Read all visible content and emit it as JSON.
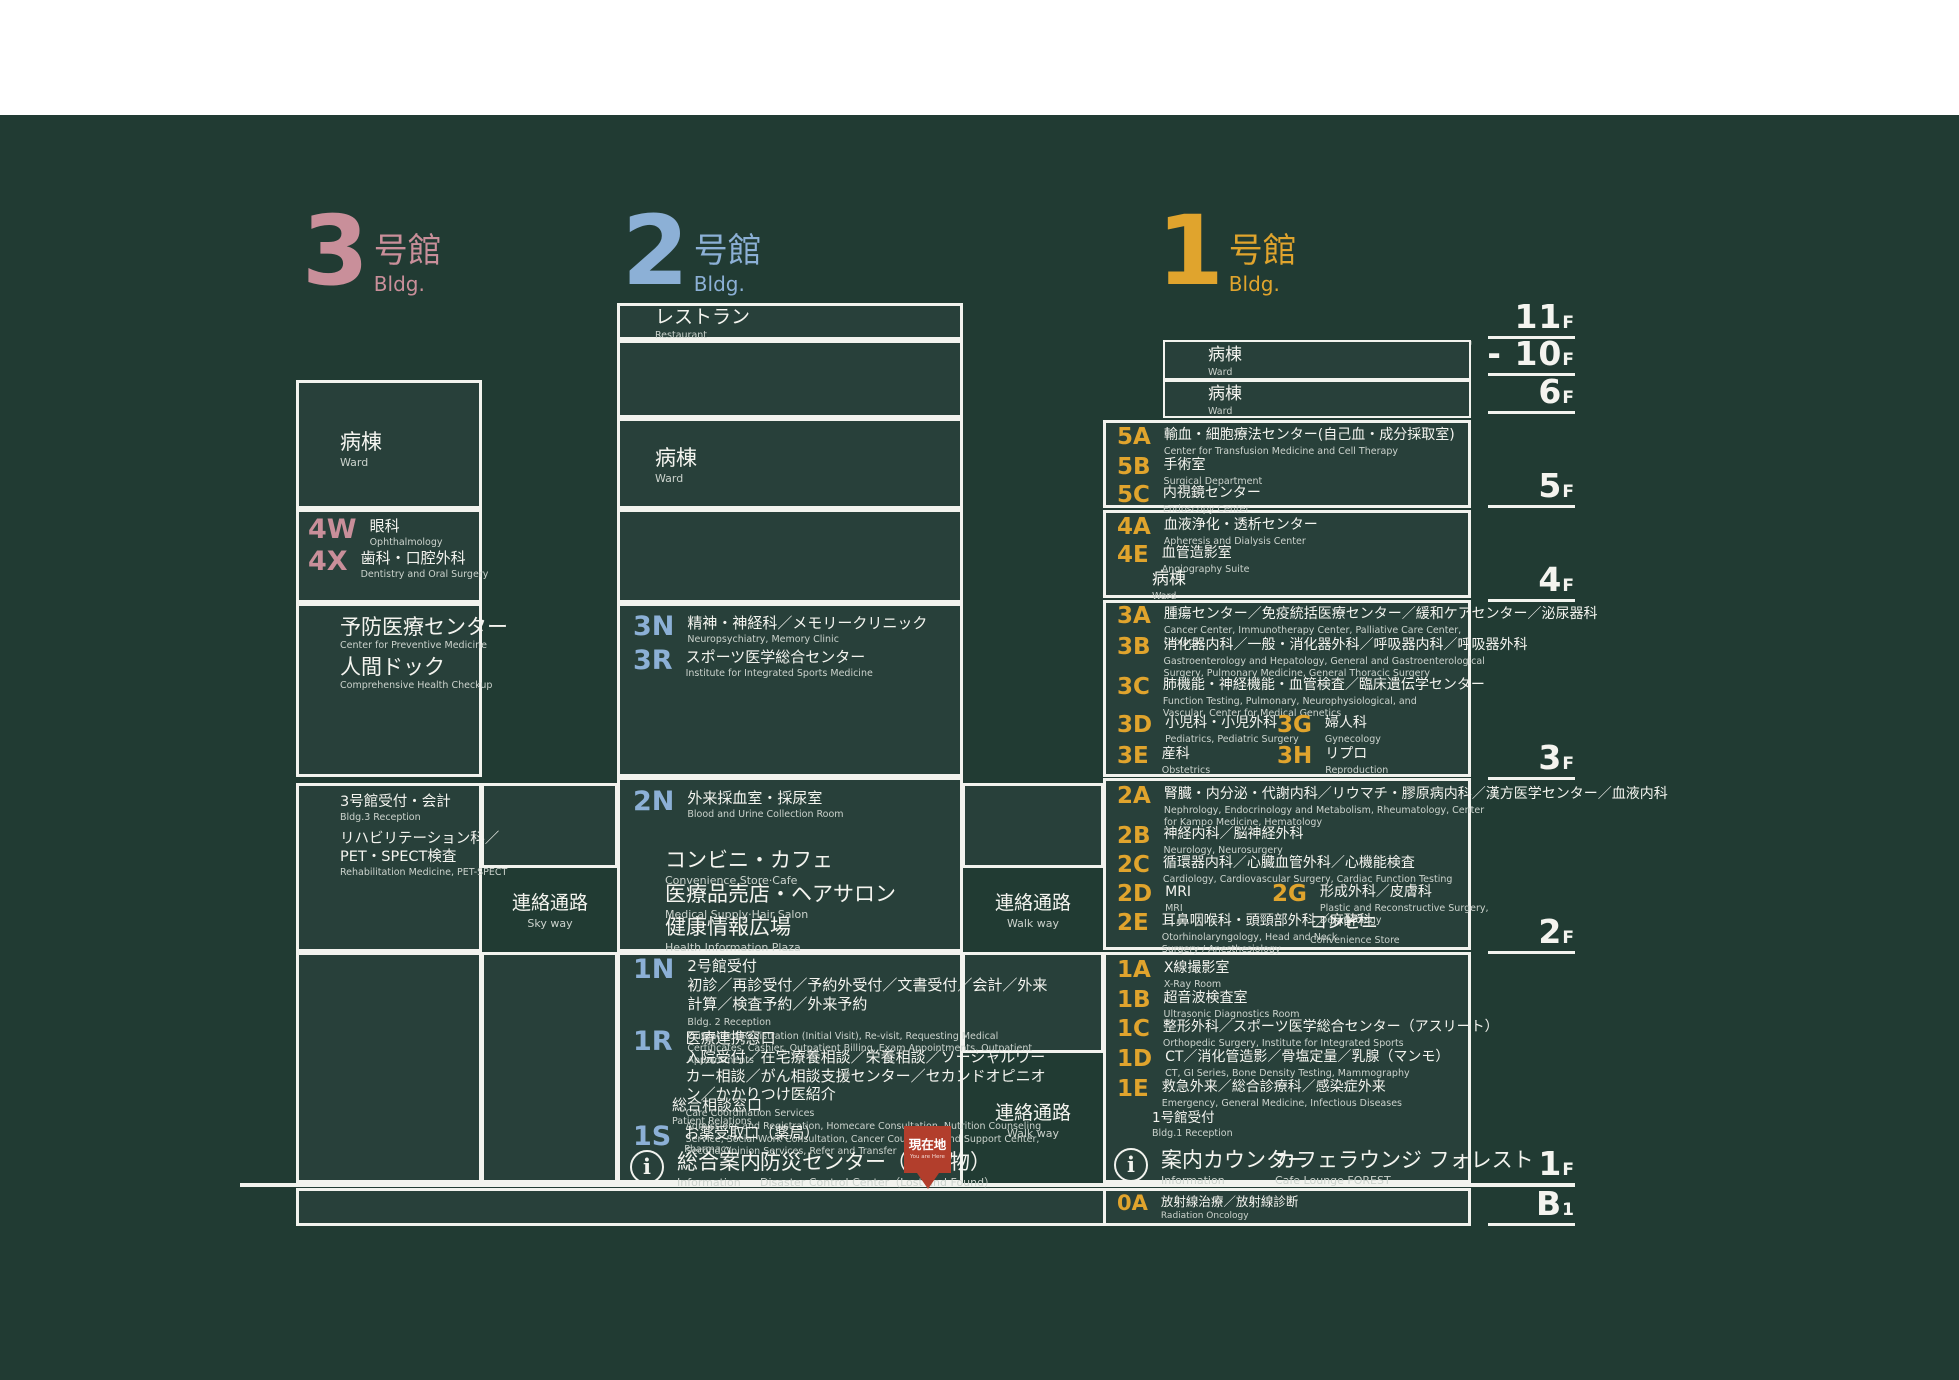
{
  "page": {
    "background": "#ffffff",
    "panel_bg": "#213b33",
    "box_border": "#f2f3ee",
    "accent_pink": "#c98f9a",
    "accent_blue": "#8cb0d6",
    "accent_gold": "#e0a42d",
    "marker_red": "#b23e2c"
  },
  "headers": {
    "b3": {
      "num": "3",
      "kan": "号館",
      "bldg": "Bldg."
    },
    "b2": {
      "num": "2",
      "kan": "号館",
      "bldg": "Bldg."
    },
    "b1": {
      "num": "1",
      "kan": "号館",
      "bldg": "Bldg."
    }
  },
  "floors": [
    {
      "n": "11",
      "s": "F"
    },
    {
      "n": "7 - 10",
      "s": "F"
    },
    {
      "n": "6",
      "s": "F"
    },
    {
      "n": "5",
      "s": "F"
    },
    {
      "n": "4",
      "s": "F"
    },
    {
      "n": "3",
      "s": "F"
    },
    {
      "n": "2",
      "s": "F"
    },
    {
      "n": "1",
      "s": "F"
    },
    {
      "n": "B",
      "s": "1"
    }
  ],
  "b3": {
    "ward": {
      "jp": "病棟",
      "en": "Ward"
    },
    "rooms": [
      {
        "code": "4W",
        "jp": "眼科",
        "en": "Ophthalmology"
      },
      {
        "code": "4X",
        "jp": "歯科・口腔外科",
        "en": "Dentistry and Oral Surgery"
      }
    ],
    "prev": [
      {
        "jp": "予防医療センター",
        "en": "Center for Preventive Medicine"
      },
      {
        "jp": "人間ドック",
        "en": "Comprehensive Health Checkup"
      }
    ],
    "recep": {
      "jp": "3号館受付・会計",
      "en": "Bldg.3 Reception"
    },
    "rehab": {
      "jp1": "リハビリテーション科／",
      "jp2": "PET・SPECT検査",
      "en": "Rehabilitation Medicine, PET-SPECT"
    },
    "skyway": {
      "jp": "連絡通路",
      "en": "Sky way"
    }
  },
  "b2": {
    "restaurant": {
      "jp": "レストラン",
      "en": "Restaurant"
    },
    "ward": {
      "jp": "病棟",
      "en": "Ward"
    },
    "rooms3": [
      {
        "code": "3N",
        "jp": "精神・神経科／メモリークリニック",
        "en": "Neuropsychiatry, Memory Clinic"
      },
      {
        "code": "3R",
        "jp": "スポーツ医学総合センター",
        "en": "Institute for Integrated Sports Medicine"
      }
    ],
    "room2n": {
      "code": "2N",
      "jp": "外来採血室・採尿室",
      "en": "Blood and Urine Collection Room"
    },
    "shops": [
      {
        "jp": "コンビニ・カフェ",
        "en": "Convenience Store·Cafe"
      },
      {
        "jp": "医療品売店・ヘアサロン",
        "en": "Medical Supply·Hair Salon"
      },
      {
        "jp": "健康情報広場",
        "en": "Health Information Plaza"
      }
    ],
    "room1n": {
      "code": "1N",
      "jp1": "2号館受付",
      "jp2": "初診／再診受付／予約外受付／文書受付／会計／外来計算／検査予約／外来予約",
      "en1": "Bldg. 2 Reception",
      "en2": "Outpatient Registration (Initial Visit), Re-visit, Requesting Medical Certificates, Cashier, Outpatient Billing, Exam Appointments, Outpatient Appointments"
    },
    "room1r": {
      "code": "1R",
      "jp1": "医療連携窓口",
      "jp2": "入院受付／在宅療養相談／栄養相談／ソーシャルワーカー相談／がん相談支援センター／セカンドオピニオン／かかりつけ医紹介",
      "en1": "Care Coordination Services",
      "en2": "Admissions and Registration, Homecare Consultation, Nutrition Counseling Service, Social Work Consultation, Cancer Counseling and Support Center, Second Opinion Services, Refer and Transfer"
    },
    "soudan": {
      "jp": "総合相談窓口",
      "en": "Patient Relations"
    },
    "room1s": {
      "code": "1S",
      "jp": "お薬受取口（薬局）",
      "en": "Pharmacy"
    },
    "info": {
      "jp": "総合案内",
      "en": "Information"
    },
    "disaster": {
      "jp": "防災センター（落し物）",
      "en": "Disaster Control Center（Lost and Found）"
    },
    "walkway": {
      "jp": "連絡通路",
      "en": "Walk way"
    }
  },
  "b1": {
    "ward710": {
      "jp": "病棟",
      "en": "Ward"
    },
    "ward6": {
      "jp": "病棟",
      "en": "Ward"
    },
    "f5": [
      {
        "code": "5A",
        "jp": "輸血・細胞療法センター(自己血・成分採取室)",
        "en": "Center for Transfusion Medicine and Cell Therapy"
      },
      {
        "code": "5B",
        "jp": "手術室",
        "en": "Surgical Department"
      },
      {
        "code": "5C",
        "jp": "内視鏡センター",
        "en": "Endoscopy Center"
      }
    ],
    "f4": [
      {
        "code": "4A",
        "jp": "血液浄化・透析センター",
        "en": "Apheresis and Dialysis Center"
      },
      {
        "code": "4E",
        "jp": "血管造影室",
        "en": "Angiography Suite"
      }
    ],
    "ward4": {
      "jp": "病棟",
      "en": "Ward"
    },
    "f3": [
      {
        "code": "3A",
        "jp": "腫瘍センター／免疫統括医療センター／緩和ケアセンター／泌尿器科",
        "en": "Cancer Center, Immunotherapy Center, Palliative Care Center, Urology"
      },
      {
        "code": "3B",
        "jp": "消化器内科／一般・消化器外科／呼吸器内科／呼吸器外科",
        "en": "Gastroenterology and Hepatology, General and Gastroenterological Surgery, Pulmonary Medicine, General Thoracic Surgery"
      },
      {
        "code": "3C",
        "jp": "肺機能・神経機能・血管検査／臨床遺伝学センター",
        "en": "Function Testing, Pulmonary, Neurophysiological, and Vascular, Center for Medical Genetics"
      },
      {
        "code": "3D",
        "jp": "小児科・小児外科",
        "en": "Pediatrics, Pediatric Surgery"
      },
      {
        "code": "3E",
        "jp": "産科",
        "en": "Obstetrics"
      }
    ],
    "f3r": [
      {
        "code": "3G",
        "jp": "婦人科",
        "en": "Gynecology"
      },
      {
        "code": "3H",
        "jp": "リプロ",
        "en": "Reproduction"
      }
    ],
    "f2": [
      {
        "code": "2A",
        "jp": "腎臓・内分泌・代謝内科／リウマチ・膠原病内科／漢方医学センター／血液内科",
        "en": "Nephrology, Endocrinology and Metabolism, Rheumatology, Center for Kampo Medicine, Hematology"
      },
      {
        "code": "2B",
        "jp": "神経内科／脳神経外科",
        "en": "Neurology, Neurosurgery"
      },
      {
        "code": "2C",
        "jp": "循環器内科／心臓血管外科／心機能検査",
        "en": "Cardiology, Cardiovascular Surgery, Cardiac Function Testing"
      },
      {
        "code": "2D",
        "jp": "MRI",
        "en": "MRI"
      },
      {
        "code": "2E",
        "jp": "耳鼻咽喉科・頭頸部外科／麻酔科",
        "en": "Otorhinolaryngology, Head and Neck Surgery / Anesthesiology"
      }
    ],
    "room2g": {
      "code": "2G",
      "jp": "形成外科／皮膚科",
      "en": "Plastic and Reconstructive Surgery, Dermatology"
    },
    "conbini": {
      "jp": "コンビニ",
      "en": "Convenience Store"
    },
    "f1": [
      {
        "code": "1A",
        "jp": "X線撮影室",
        "en": "X-Ray Room"
      },
      {
        "code": "1B",
        "jp": "超音波検査室",
        "en": "Ultrasonic Diagnostics Room"
      },
      {
        "code": "1C",
        "jp": "整形外科／スポーツ医学総合センター（アスリート）",
        "en": "Orthopedic Surgery, Institute for Integrated Sports"
      },
      {
        "code": "1D",
        "jp": "CT／消化管造影／骨塩定量／乳腺（マンモ）",
        "en": "CT, GI Series, Bone Density Testing, Mammography"
      },
      {
        "code": "1E",
        "jp": "救急外来／総合診療科／感染症外来",
        "en": "Emergency, General Medicine, Infectious Diseases"
      }
    ],
    "recep": {
      "jp": "1号館受付",
      "en": "Bldg.1 Reception"
    },
    "info": {
      "jp": "案内カウンター",
      "en": "Information"
    },
    "cafe": {
      "jp": "カフェラウンジ フォレスト",
      "en": "Cafe Lounge FOREST"
    },
    "room0a": {
      "code": "0A",
      "jp": "放射線治療／放射線診断",
      "en": "Radiation Oncology"
    }
  },
  "marker": {
    "jp": "現在地",
    "en": "You are Here"
  }
}
